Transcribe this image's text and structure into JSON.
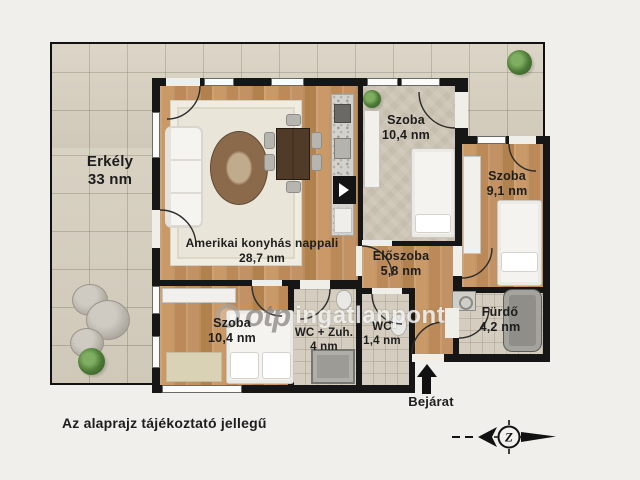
{
  "rooms": [
    {
      "id": "erkely",
      "name": "Erkély",
      "area": "33 nm"
    },
    {
      "id": "nappali",
      "name": "Amerikai konyhás nappali",
      "area": "28,7 nm"
    },
    {
      "id": "szoba_felso",
      "name": "Szoba",
      "area": "10,4 nm"
    },
    {
      "id": "szoba_jobb",
      "name": "Szoba",
      "area": "9,1 nm"
    },
    {
      "id": "eloszoba",
      "name": "Előszoba",
      "area": "5,8 nm"
    },
    {
      "id": "szoba_also",
      "name": "Szoba",
      "area": "10,4 nm"
    },
    {
      "id": "wc_zuh",
      "name": "WC + Zuh.",
      "area": "4 nm"
    },
    {
      "id": "wc",
      "name": "WC",
      "area": "1,4 nm"
    },
    {
      "id": "furdo",
      "name": "Fürdő",
      "area": "4,2 nm"
    }
  ],
  "entrance": {
    "label": "Bejárat"
  },
  "disclaimer": "Az alaprajz tájékoztató jellegű",
  "watermark": {
    "brand": "otp",
    "suffix": "ingatlanpont"
  },
  "compass": {
    "letter": "Z"
  },
  "colors": {
    "wall": "#161616",
    "wood": "#c2915f",
    "terrace_tile": "#d8d1c1",
    "background": "#f0efeb",
    "plant_green": "#4c7a37"
  }
}
